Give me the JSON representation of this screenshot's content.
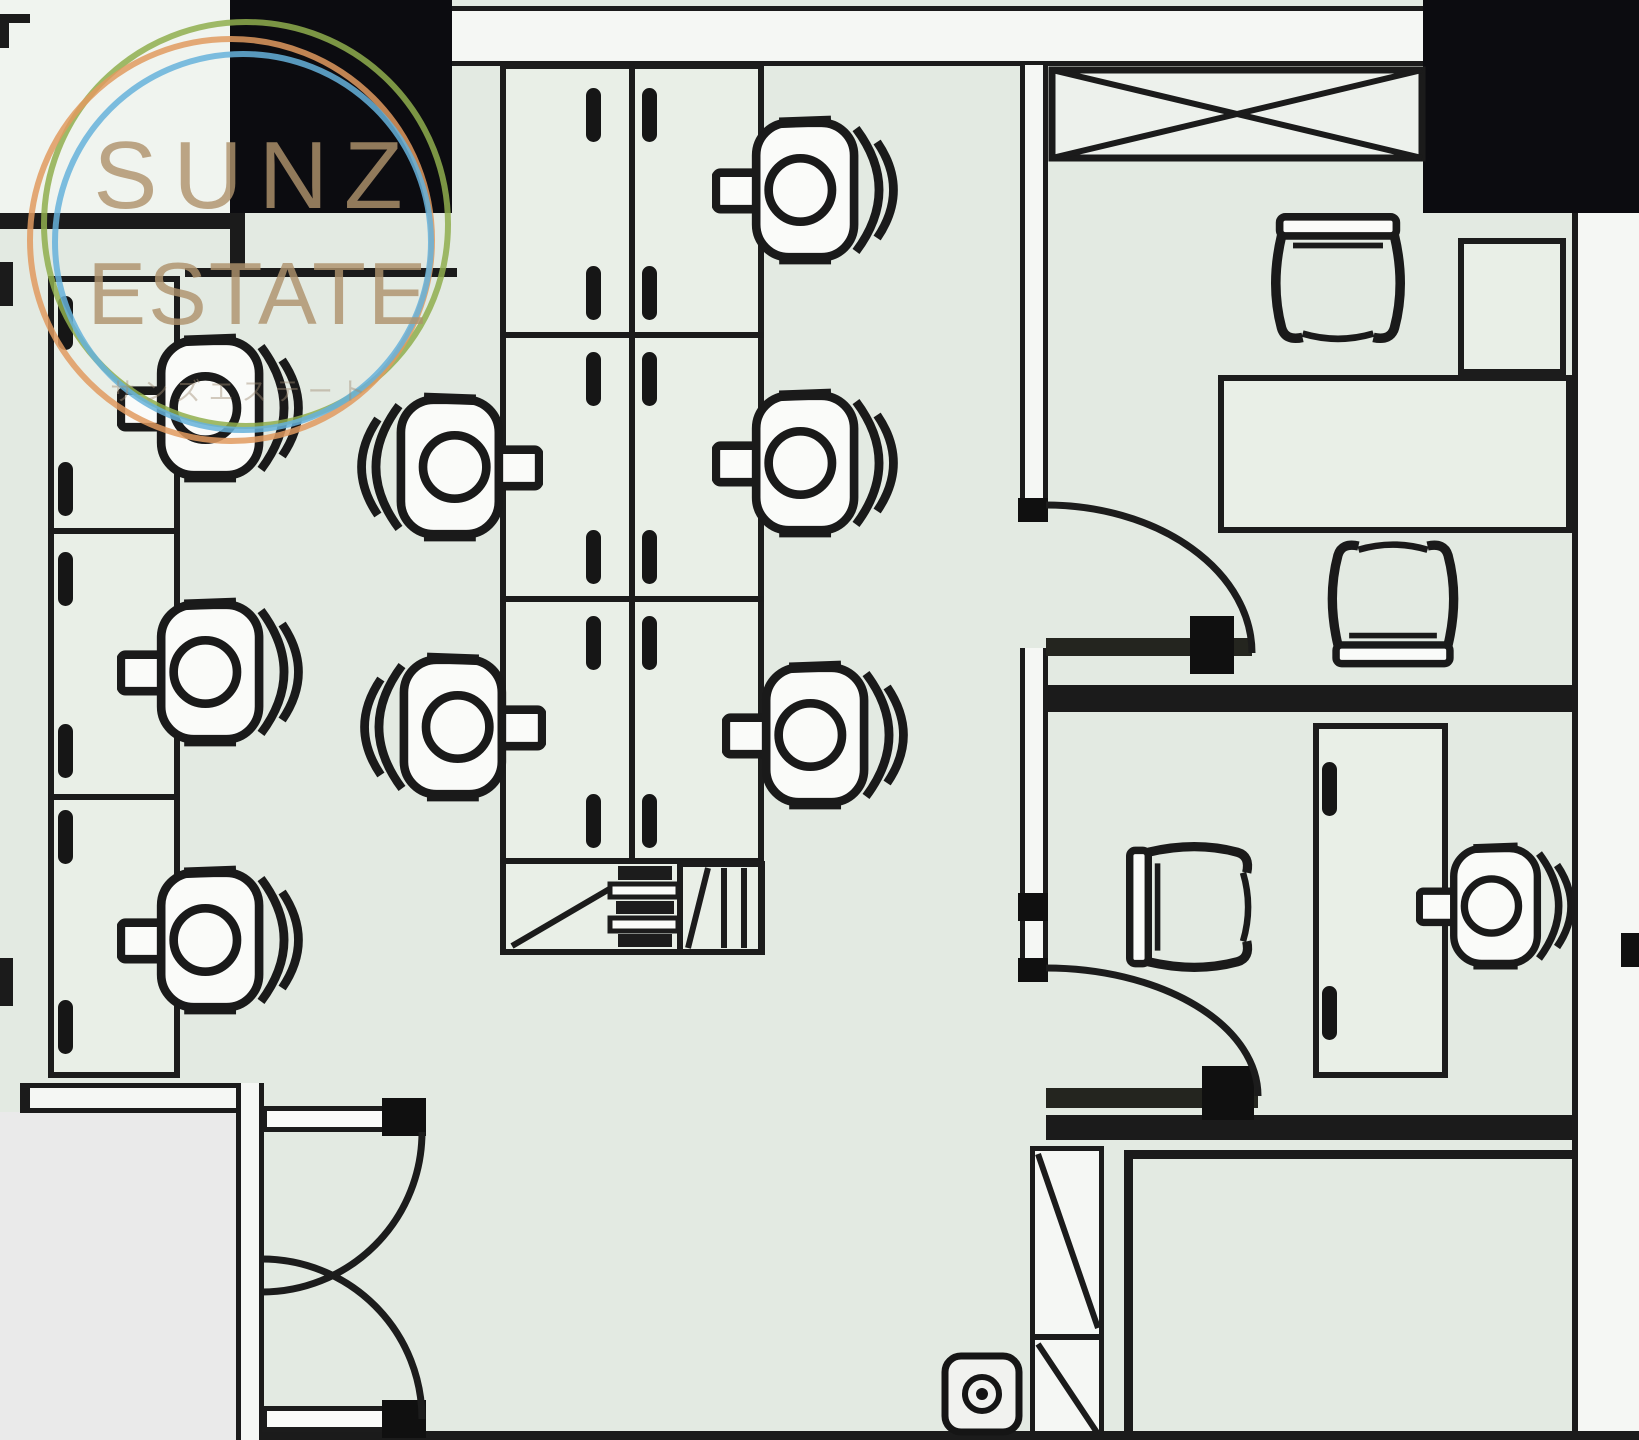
{
  "watermark": {
    "brand_line1": "SUNZ",
    "brand_line2": "ESTATE",
    "brand_line3_kana": "サンズエステート",
    "ring_colors": {
      "orange": "#e09a5f",
      "green": "#8fae4e",
      "blue": "#66b1da"
    },
    "text_color": "#af916c"
  },
  "plan": {
    "type": "office-floor-plan",
    "floor_color": "#e3eae2",
    "wall_color": "#1b1b1b",
    "column_color": "#0c0c10",
    "rooms": [
      {
        "name": "open-office-area"
      },
      {
        "name": "private-office-upper"
      },
      {
        "name": "private-office-lower"
      },
      {
        "name": "storage-room-bottom-right"
      },
      {
        "name": "entrance-room-bottom-left"
      },
      {
        "name": "upper-left-room"
      }
    ],
    "furniture": {
      "workstation_desks": 9,
      "private_desks": 2,
      "office_chairs": 9,
      "guest_chairs": 3,
      "cabinets": 2,
      "crossed_storage_units": 1,
      "printer_units": 1,
      "floor_outlets": 1,
      "single_doors": 2,
      "double_door_leaves": 2
    }
  }
}
